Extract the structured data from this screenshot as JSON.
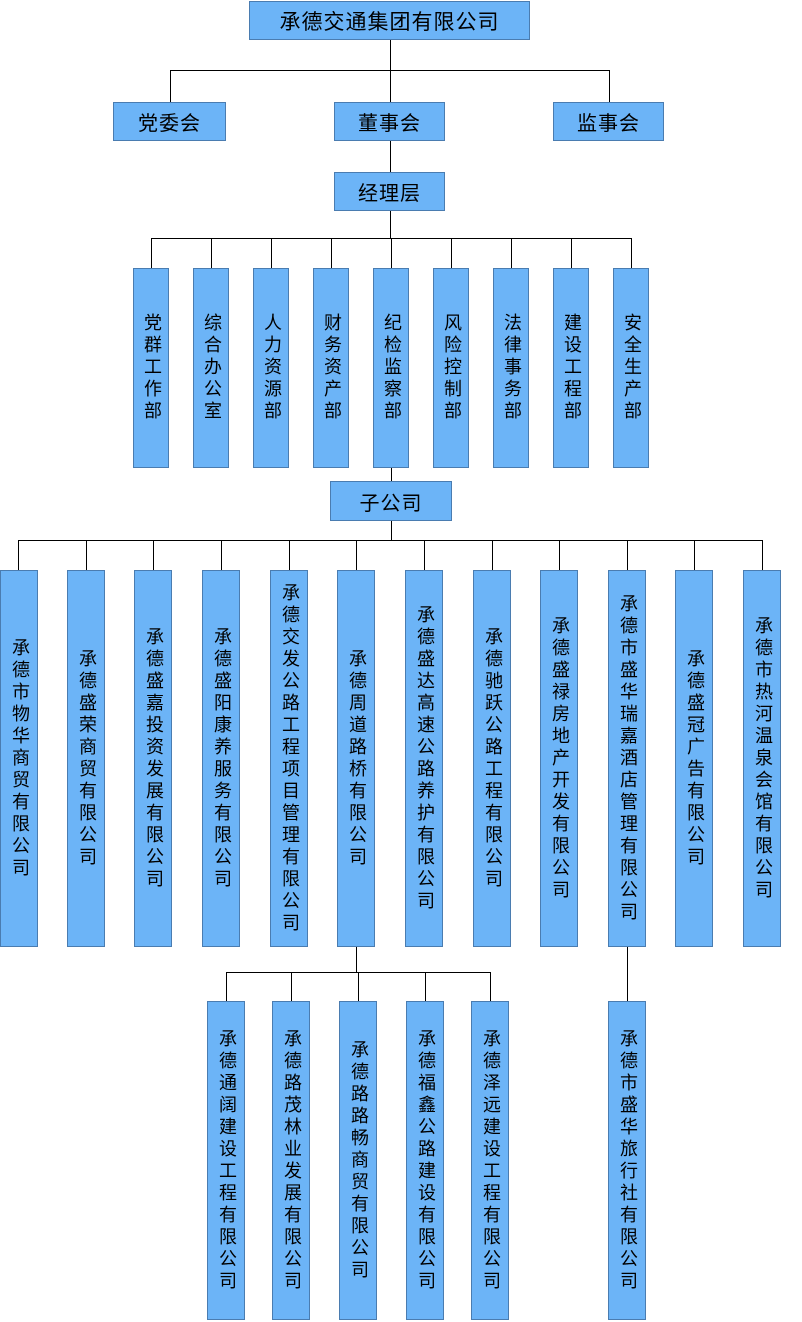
{
  "org": {
    "root": "承德交通集团有限公司",
    "party_committee": "党委会",
    "board": "董事会",
    "supervisory": "监事会",
    "management": "经理层",
    "departments": [
      "党群工作部",
      "综合办公室",
      "人力资源部",
      "财务资产部",
      "纪检监察部",
      "风险控制部",
      "法律事务部",
      "建设工程部",
      "安全生产部"
    ],
    "subsidiaries_label": "子公司",
    "subsidiaries": [
      "承德市物华商贸有限公司",
      "承德盛荣商贸有限公司",
      "承德盛嘉投资发展有限公司",
      "承德盛阳康养服务有限公司",
      "承德交发公路工程项目管理有限公司",
      "承德周道路桥有限公司",
      "承德盛达高速公路养护有限公司",
      "承德驰跃公路工程有限公司",
      "承德盛禄房地产开发有限公司",
      "承德市盛华瑞嘉酒店管理有限公司",
      "承德盛冠广告有限公司",
      "承德市热河温泉会馆有限公司"
    ],
    "zhoudao_children": [
      "承德通阔建设工程有限公司",
      "承德路茂林业发展有限公司",
      "承德路路畅商贸有限公司",
      "承德福鑫公路建设有限公司",
      "承德泽远建设工程有限公司"
    ],
    "shenghua_children": [
      "承德市盛华旅行社有限公司"
    ]
  },
  "colors": {
    "box_fill": "#6CB4F7",
    "box_border": "#4A7CB0",
    "connector": "#000000",
    "text": "#000000"
  }
}
